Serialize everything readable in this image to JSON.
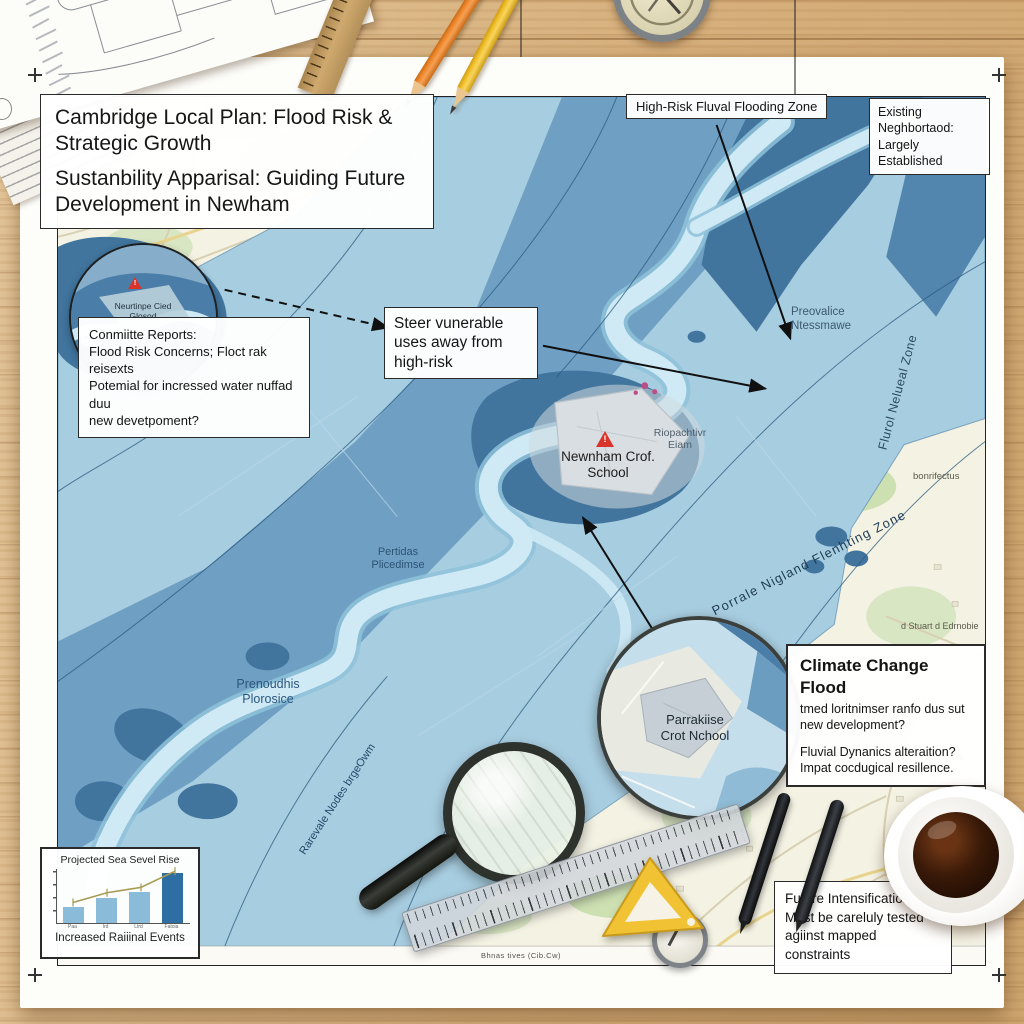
{
  "icons": {
    "warning_glyph": "!"
  },
  "colors": {
    "map_base": "#f4f2e3",
    "flood_light": "#a7cde0",
    "flood_medium": "#6b9dc1",
    "flood_dark": "#41759e",
    "river": "#cfeaf5",
    "warning_red": "#d9342b",
    "desk_wood": "#d7b07d"
  },
  "title_box": {
    "heading": "Cambridge Local Plan: Flood Risk & Strategic Growth",
    "subheading": "Sustanbility Apparisal: Guiding Future Development in Newham"
  },
  "top_labels": {
    "high_risk_zone": "High-Risk Fluval Flooding Zone",
    "existing_neighborhood": "Existing Neghbortaod: Largely Established"
  },
  "callouts": {
    "committee": {
      "lines": [
        "Conmiitte Reports:",
        "Flood Risk Concerns;  Floct rak  reisexts",
        "Potemial for incressed water nuffad duu",
        "new devetpoment?"
      ]
    },
    "steer": {
      "text": "Steer vunerable uses away from high-risk"
    },
    "climate": {
      "title": "Climate Change Flood",
      "para1": "tmed loritnimser ranfo dus sut new development?",
      "para2_line1": "Fluvial Dynanics alteraition?",
      "para2_line2": "Impat cocdugical resillence."
    },
    "future": {
      "lines": [
        "Future Intensification:",
        "Must be careluly tested",
        "agiinst mapped constraints"
      ]
    }
  },
  "map_labels": {
    "inset_school": {
      "line1": "Neurtinpe Cied",
      "line2": "Glosod"
    },
    "newnham_school": {
      "line1": "Newnham Crof.",
      "line2": "School"
    },
    "magnified_school": {
      "line1": "Parrakiise",
      "line2": "Crot Nchool"
    },
    "riopachtivr": {
      "line1": "Riopachtivr",
      "line2": "Eiam"
    },
    "preovalice": {
      "line1": "Preovalice",
      "line2": "Ntessmawe"
    },
    "pertidas": {
      "line1": "Pertidas",
      "line2": "Plicedimse"
    },
    "prenoudhis": {
      "line1": "Prenoudhis",
      "line2": "Plorosice"
    },
    "fluval_zone_rotated": "Flurol Nelueal Zone",
    "flooding_zone_rotated": "Porrale Nigland Flenhting Zone",
    "rarevale_rotated": "Rarevale Nodes brgeOwm",
    "bonrifectus": "bonrifectus",
    "stuart_edrnobie": "d Stuart d Edrnobie",
    "ebnsids": "Ebnsids",
    "bottom_caption": "Bhnas tives (Cib.Cw)"
  },
  "chart_data": {
    "type": "bar",
    "title": "Projected Sea Sevel Rise",
    "caption": "Increased Raiiinal Events",
    "categories": [
      "Paa",
      "Ird",
      "Ltrd",
      "Fatoia"
    ],
    "values": [
      30,
      46,
      57,
      92
    ],
    "series": [
      {
        "name": "trend",
        "values": [
          38,
          56,
          66,
          96
        ]
      }
    ],
    "bar_colors": [
      "#8abbd9",
      "#8abbd9",
      "#8abbd9",
      "#2f6ea3"
    ],
    "trend_color": "#a89a52",
    "ylim": [
      0,
      100
    ],
    "grid": false,
    "legend": false
  }
}
